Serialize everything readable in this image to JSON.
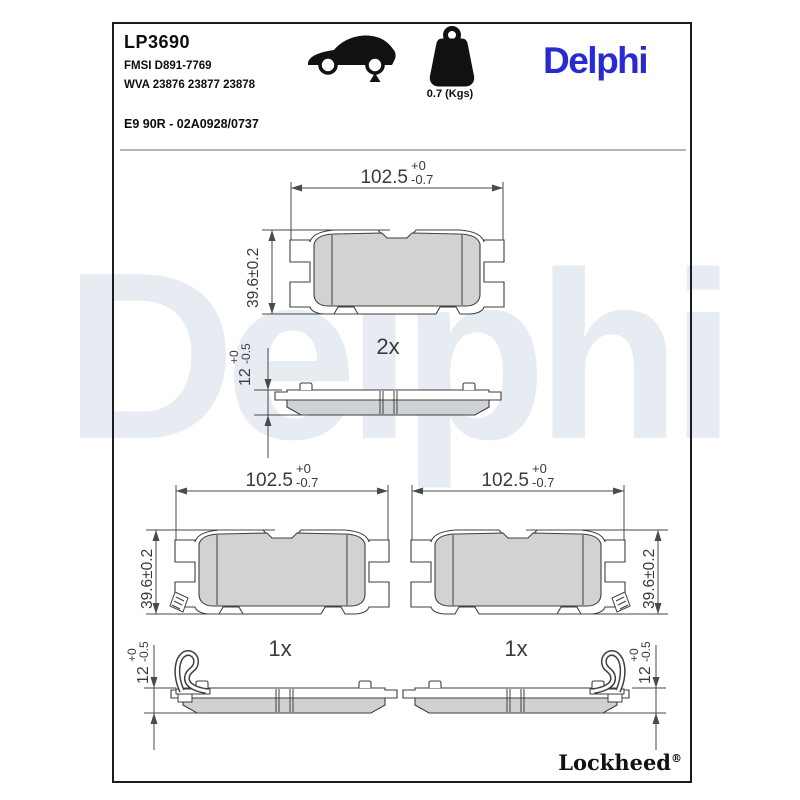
{
  "header": {
    "part_number": "LP3690",
    "fmsi": "FMSI D891-7769",
    "wva": "WVA 23876 23877 23878",
    "approval": "E9 90R - 02A0928/0737",
    "weight_label": "0.7 (Kgs)",
    "brand": "Delphi",
    "icons": {
      "car": "car-side-silhouette-rear-axle-marker",
      "weight": "kettlebell-weight"
    }
  },
  "watermark_text": "Delphi",
  "footer": {
    "brand": "Lockheed",
    "registered": "®"
  },
  "colors": {
    "brand_blue": "#2a2ad2",
    "watermark_blue": "#e7ebf2",
    "friction_fill": "#d2d2d2",
    "drawing_line": "#3f3f3f"
  },
  "drawings": {
    "pad_2x": {
      "quantity": "2x",
      "width": {
        "value": "102.5",
        "tol_plus": "+0",
        "tol_minus": "-0.7"
      },
      "height": {
        "value": "39.6±0.2"
      },
      "thickness": {
        "value": "12",
        "tol_plus": "+0",
        "tol_minus": "-0.5"
      }
    },
    "pad_1x_left": {
      "quantity": "1x",
      "width": {
        "value": "102.5",
        "tol_plus": "+0",
        "tol_minus": "-0.7"
      },
      "height": {
        "value": "39.6±0.2"
      },
      "thickness": {
        "value": "12",
        "tol_plus": "+0",
        "tol_minus": "-0.5"
      }
    },
    "pad_1x_right": {
      "quantity": "1x",
      "width": {
        "value": "102.5",
        "tol_plus": "+0",
        "tol_minus": "-0.7"
      },
      "height": {
        "value": "39.6±0.2"
      },
      "thickness": {
        "value": "12",
        "tol_plus": "+0",
        "tol_minus": "-0.5"
      }
    }
  }
}
